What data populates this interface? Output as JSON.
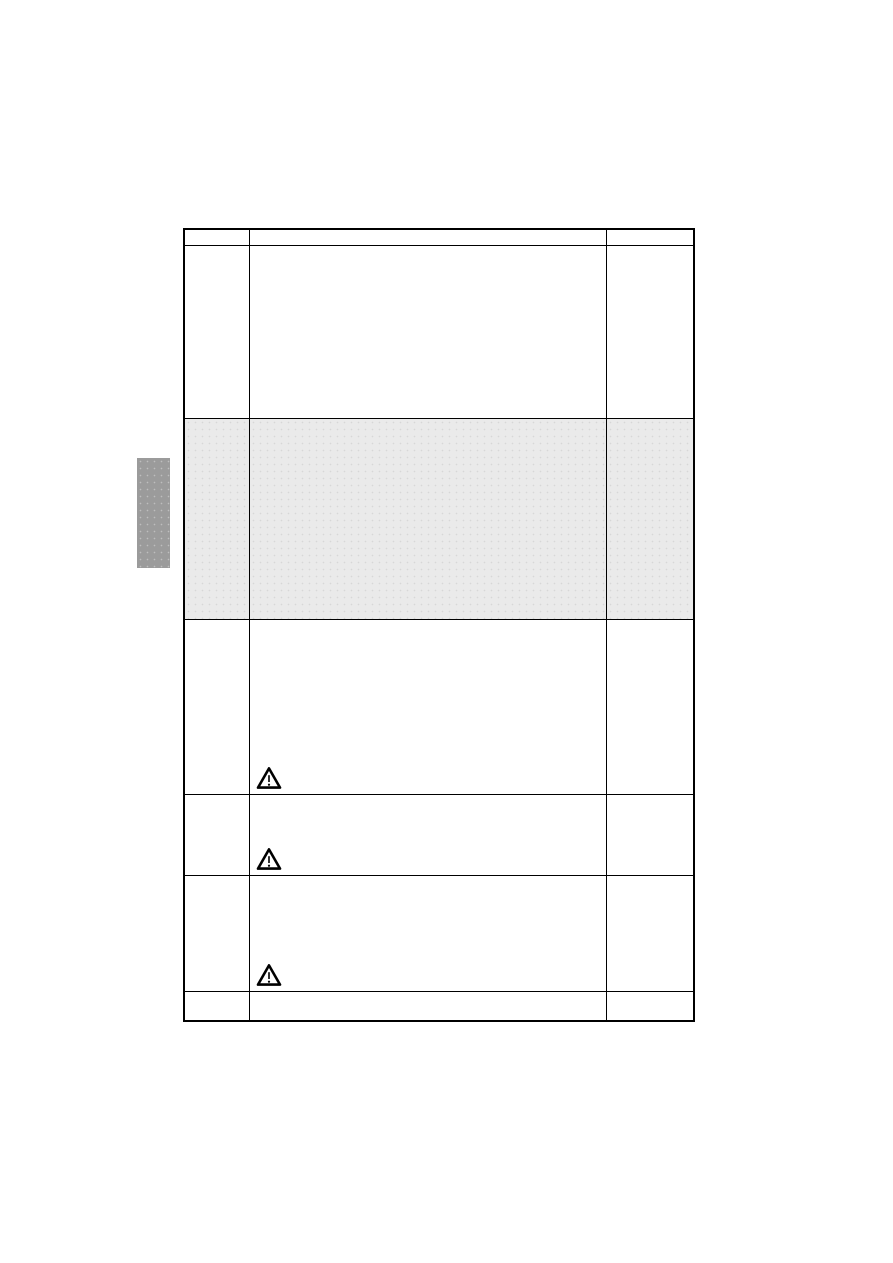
{
  "page": {
    "background": "#ffffff"
  },
  "section_tab": {
    "color": "#9b9b9b"
  },
  "table": {
    "border_color": "#000000",
    "shaded_row_color": "#eaeaea",
    "columns": 3,
    "header": {
      "cells": [
        "",
        "",
        ""
      ]
    },
    "rows": [
      {
        "cells": [
          "",
          "",
          ""
        ],
        "shaded": false,
        "warning_icon": false
      },
      {
        "cells": [
          "",
          "",
          ""
        ],
        "shaded": true,
        "warning_icon": false
      },
      {
        "cells": [
          "",
          "",
          ""
        ],
        "shaded": false,
        "warning_icon": true
      },
      {
        "cells": [
          "",
          "",
          ""
        ],
        "shaded": false,
        "warning_icon": true
      },
      {
        "cells": [
          "",
          "",
          ""
        ],
        "shaded": false,
        "warning_icon": true
      },
      {
        "cells": [
          "",
          "",
          ""
        ],
        "shaded": false,
        "warning_icon": false
      }
    ],
    "warning_icon_name": "warning-triangle-icon"
  }
}
